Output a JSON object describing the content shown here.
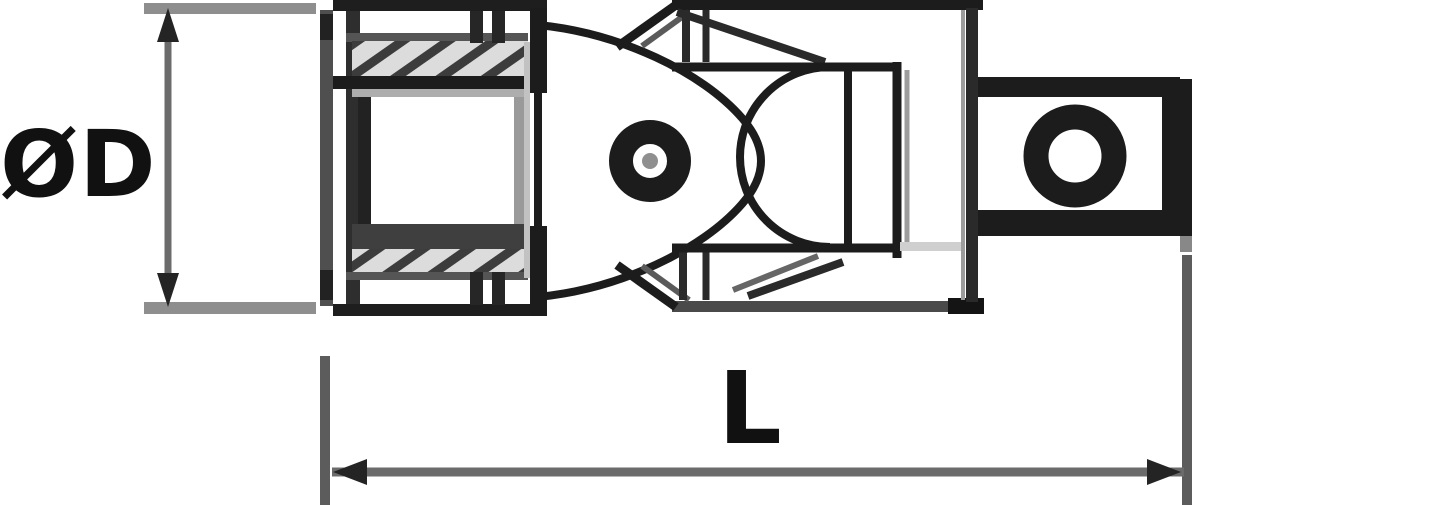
{
  "diagram": {
    "type": "technical-drawing",
    "subject": "universal-joint-socket-adapter",
    "labels": {
      "diameter": "ØD",
      "length": "L"
    },
    "dimensions": [
      {
        "label": "ØD",
        "orientation": "vertical"
      },
      {
        "label": "L",
        "orientation": "horizontal"
      }
    ],
    "colors": {
      "outline": "#1c1c1c",
      "dimension_line": "#6b6b6b",
      "extension_line": "#8e8e8e",
      "arrowhead": "#242424",
      "label_text": "#111111",
      "hatch_dark": "#3c3c3c",
      "hatch_light": "#dcdcdc",
      "background": "#ffffff"
    }
  }
}
